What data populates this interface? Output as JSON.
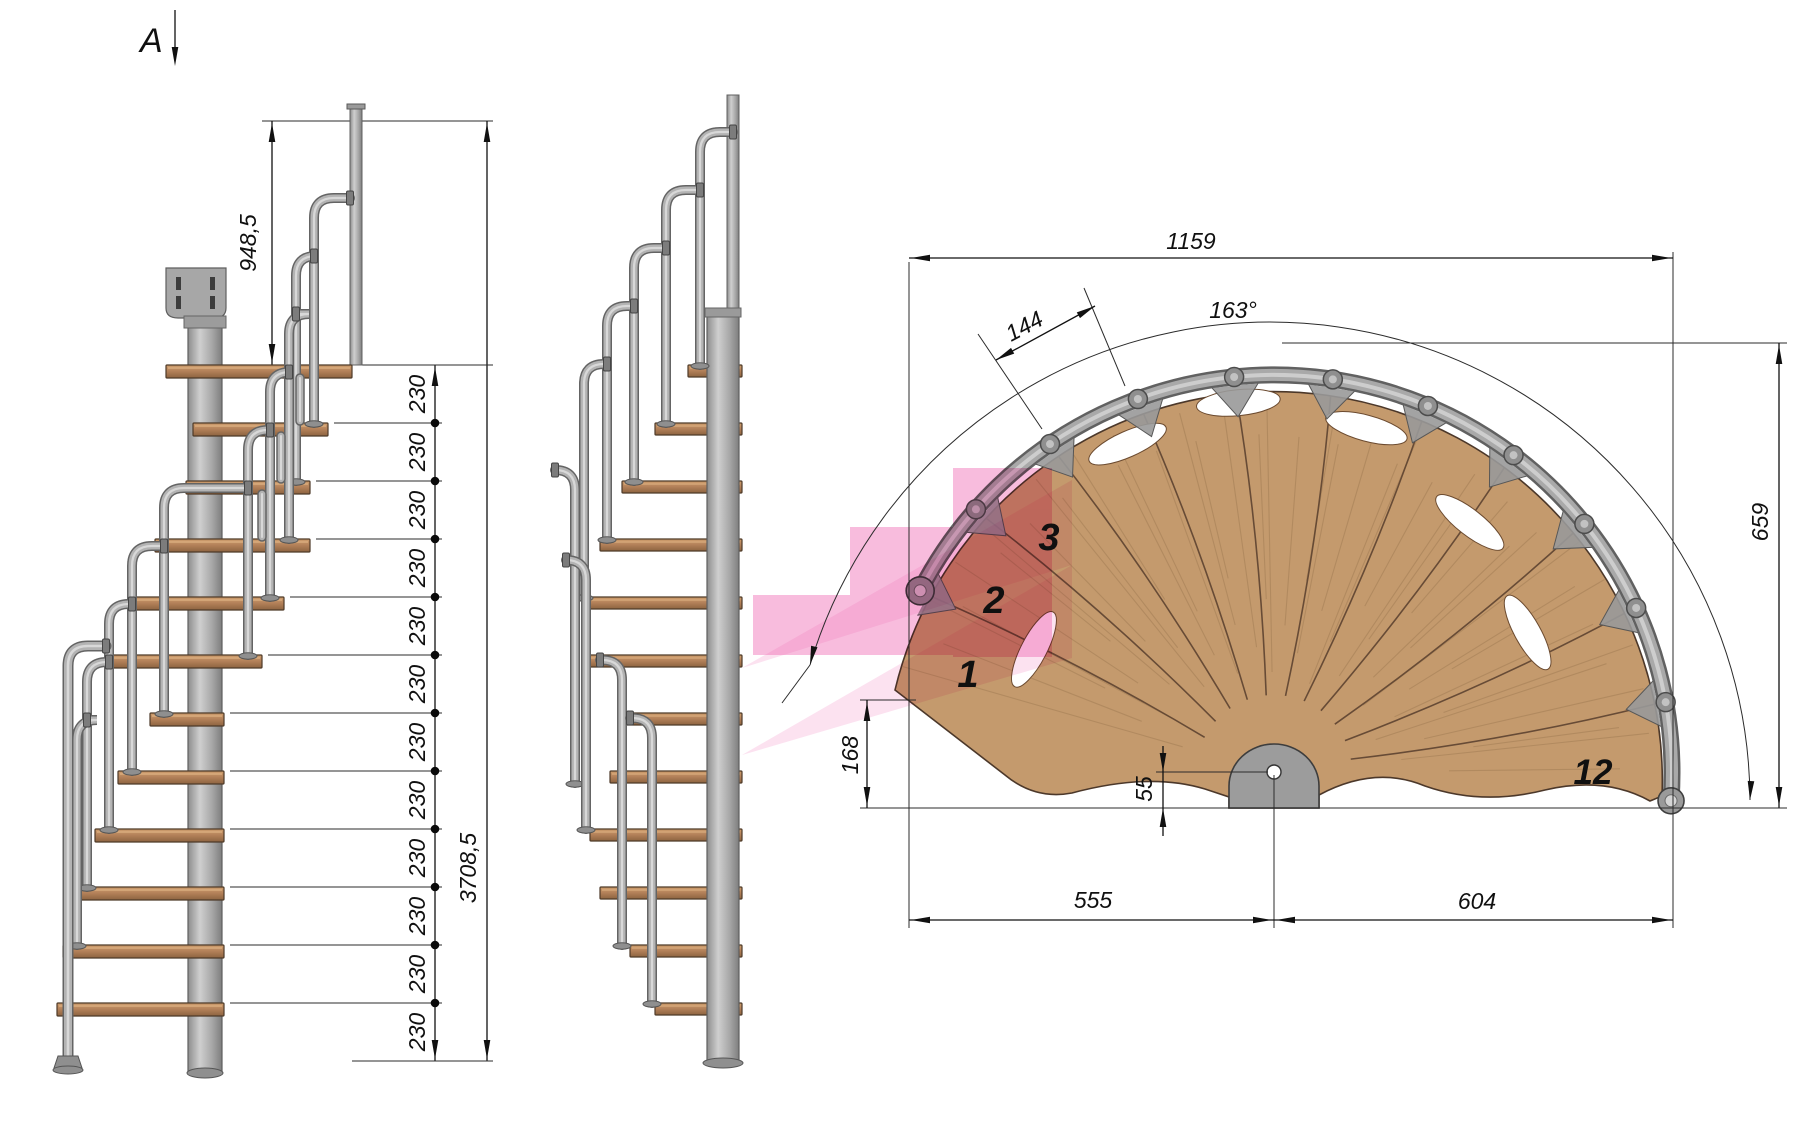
{
  "drawing": {
    "section_label": "A",
    "left_view": {
      "label": "side elevation",
      "top_height": "948,5",
      "total_height": "3708,5",
      "riser_labels": [
        "230",
        "230",
        "230",
        "230",
        "230",
        "230",
        "230",
        "230",
        "230",
        "230",
        "230",
        "230"
      ]
    },
    "plan_view": {
      "label": "top plan view",
      "overall_width": "1159",
      "sweep_angle": "163°",
      "tread_outer_width": "144",
      "depth_right": "659",
      "entry_depth": "168",
      "center_offset": "55",
      "span_left": "555",
      "span_right": "604",
      "step_labels": [
        "1",
        "2",
        "3",
        "12"
      ]
    },
    "colors": {
      "wood": "#c49a6d",
      "wood_edge": "#4c382a",
      "steel": "#b3b3b3",
      "steel_dark": "#686868",
      "highlight_pink": "#ee5fae",
      "line": "#111111"
    }
  }
}
